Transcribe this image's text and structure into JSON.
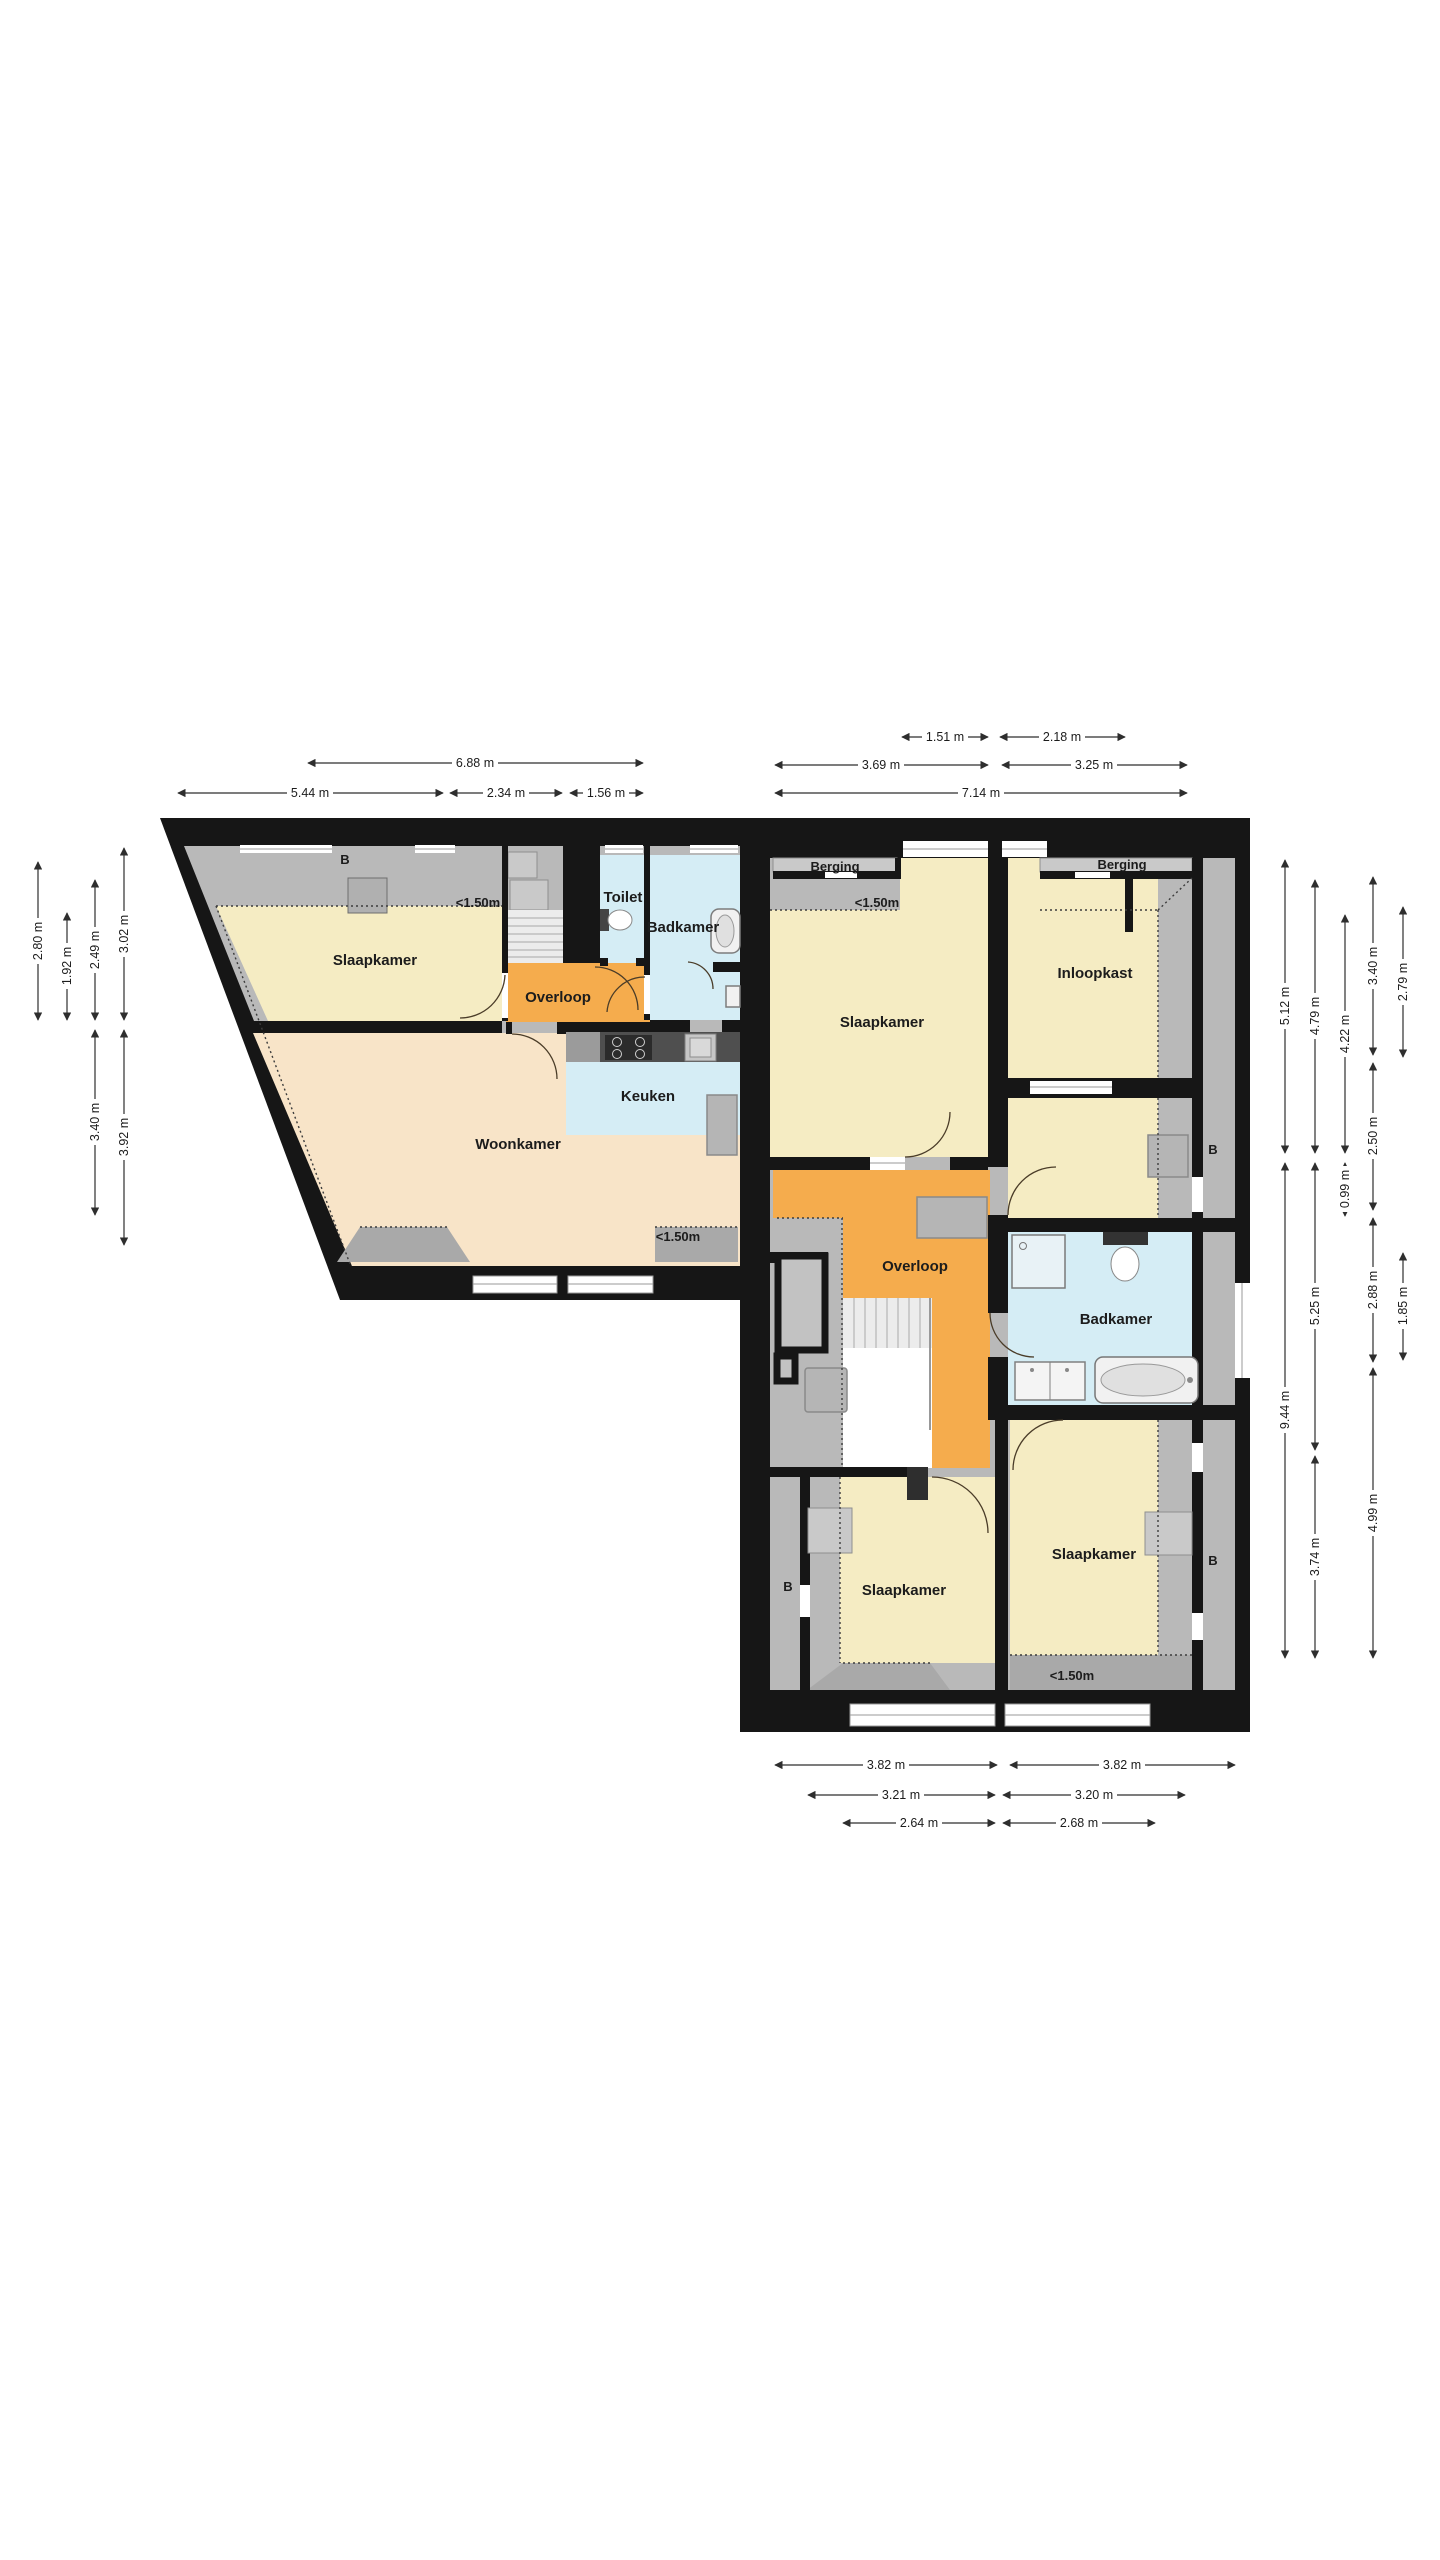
{
  "rooms": {
    "slaapkamer1": "Slaapkamer",
    "overloop1": "Overloop",
    "toilet": "Toilet",
    "badkamer1": "Badkamer",
    "keuken": "Keuken",
    "woonkamer": "Woonkamer",
    "berging1": "Berging",
    "slaapkamer2": "Slaapkamer",
    "berging2": "Berging",
    "inloopkast": "Inloopkast",
    "overloop2": "Overloop",
    "badkamer2": "Badkamer",
    "slaapkamer3": "Slaapkamer",
    "slaapkamer4": "Slaapkamer"
  },
  "annotations": {
    "height_limit": "<1.50m",
    "beam": "B"
  },
  "dims": {
    "top": [
      "6.88 m",
      "5.44 m",
      "2.34 m",
      "1.56 m",
      "1.51 m",
      "2.18 m",
      "3.69 m",
      "3.25 m",
      "7.14 m"
    ],
    "left": [
      "2.80 m",
      "1.92 m",
      "2.49 m",
      "3.02 m",
      "3.40 m",
      "3.92 m"
    ],
    "right": [
      "5.12 m",
      "9.44 m",
      "4.79 m",
      "5.25 m",
      "3.74 m",
      "4.22 m",
      "0.99 m",
      "3.40 m",
      "2.50 m",
      "2.88 m",
      "4.99 m",
      "2.79 m",
      "1.85 m"
    ],
    "bottom": [
      "3.82 m",
      "3.82 m",
      "3.21 m",
      "3.20 m",
      "2.64 m",
      "2.68 m"
    ]
  },
  "colors": {
    "wall": "#161616",
    "room_yellow": "#f5ecc3",
    "hall_orange": "#f5ac4d",
    "living_peach": "#f8e4c8",
    "wet_blue": "#d5edf5",
    "attic_gray": "#b9b9b9",
    "dormer_gray": "#a9a9a9"
  }
}
